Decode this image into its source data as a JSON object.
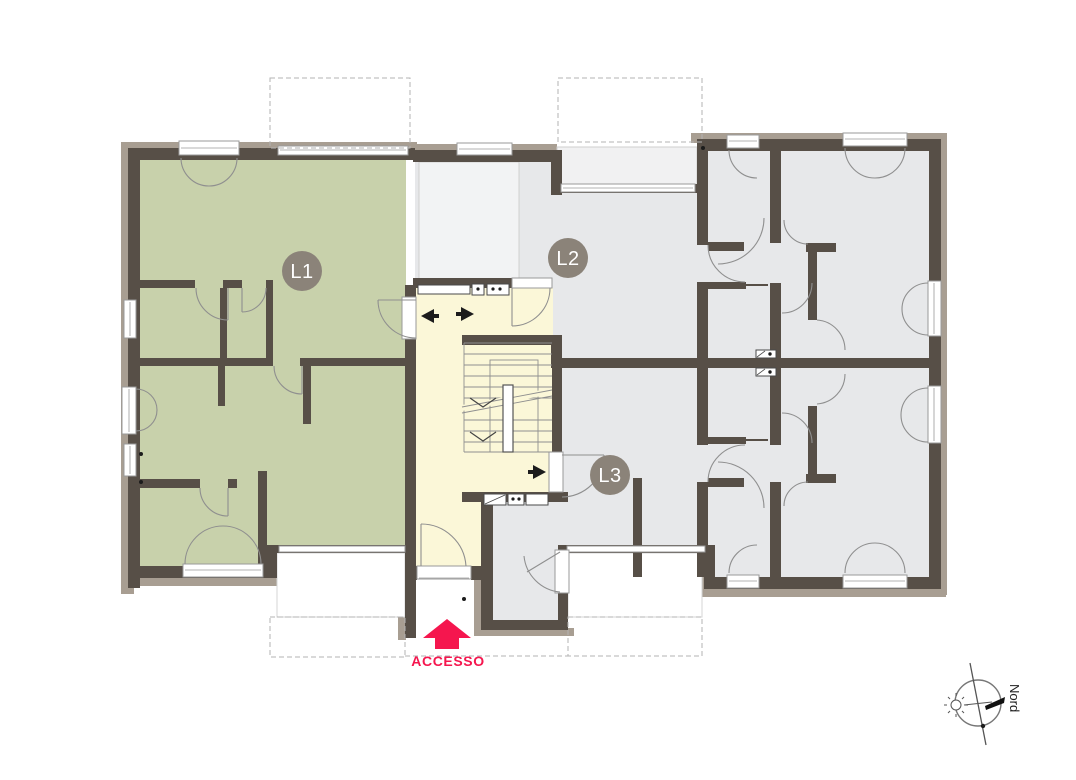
{
  "floorplan": {
    "units": [
      {
        "id": "l1",
        "label": "L1"
      },
      {
        "id": "l2",
        "label": "L2"
      },
      {
        "id": "l3",
        "label": "L3"
      }
    ],
    "access_label": "ACCESSO",
    "compass_label": "Nord",
    "colors": {
      "unit_l1_fill": "#c8d1ab",
      "unit_l2_fill": "#e7e8ea",
      "unit_l3_fill": "#e7e8ea",
      "stairwell_fill": "#fbf7d8",
      "wall": "#574f47",
      "wall_cladding": "#a89e92",
      "unit_badge": "#8b8379",
      "access_red": "#f5164e"
    }
  }
}
